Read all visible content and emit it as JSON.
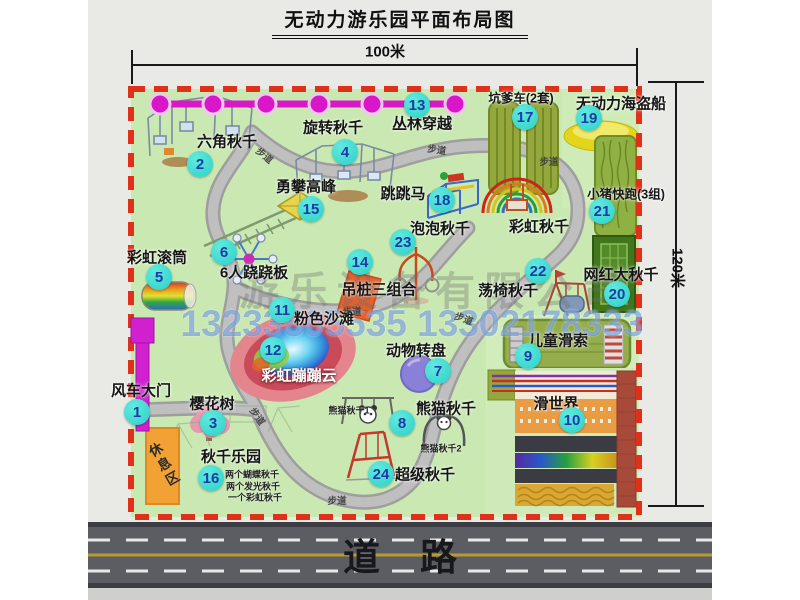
{
  "title": "无动力游乐园平面布局图",
  "dimensions": {
    "width_label": "100米",
    "height_label": "120米"
  },
  "road_label": "道路",
  "rest_area_label": "休息区",
  "watermark": {
    "company": "游乐设备有限公司",
    "phones": "13233805535 13302178333"
  },
  "map": {
    "attractions": [
      {
        "num": "1",
        "name": "windmill-gate",
        "label": "风车大门",
        "bx": 137,
        "by": 412,
        "lx": 141,
        "ly": 390
      },
      {
        "num": "2",
        "name": "hexagon-swing",
        "label": "六角秋千",
        "bx": 200,
        "by": 164,
        "lx": 227,
        "ly": 141
      },
      {
        "num": "3",
        "name": "cherry-tree",
        "label": "樱花树",
        "bx": 213,
        "by": 423,
        "lx": 212,
        "ly": 403
      },
      {
        "num": "4",
        "name": "rotating-swing",
        "label": "旋转秋千",
        "bx": 345,
        "by": 152,
        "lx": 333,
        "ly": 127
      },
      {
        "num": "5",
        "name": "rainbow-roller",
        "label": "彩虹滚筒",
        "bx": 159,
        "by": 277,
        "lx": 157,
        "ly": 257
      },
      {
        "num": "6",
        "name": "six-seesaw",
        "label": "6人跷跷板",
        "bx": 224,
        "by": 252,
        "lx": 254,
        "ly": 272
      },
      {
        "num": "7",
        "name": "animal-turntable",
        "label": "动物转盘",
        "bx": 438,
        "by": 371,
        "lx": 416,
        "ly": 350
      },
      {
        "num": "8",
        "name": "panda-swing",
        "label": "熊猫秋千",
        "bx": 402,
        "by": 423,
        "lx": 446,
        "ly": 408,
        "subs": [
          {
            "text": "熊猫秋千1",
            "x": 349,
            "y": 410
          },
          {
            "text": "熊猫秋千2",
            "x": 441,
            "y": 448
          }
        ]
      },
      {
        "num": "9",
        "name": "kids-zipline",
        "label": "儿童滑索",
        "bx": 528,
        "by": 356,
        "lx": 558,
        "ly": 340
      },
      {
        "num": "10",
        "name": "slide-world",
        "label": "滑世界",
        "bx": 572,
        "by": 420,
        "lx": 556,
        "ly": 403
      },
      {
        "num": "11",
        "name": "pink-beach",
        "label": "粉色沙滩",
        "bx": 282,
        "by": 310,
        "lx": 324,
        "ly": 318
      },
      {
        "num": "12",
        "name": "rainbow-cloud",
        "label": "彩虹蹦蹦云",
        "bx": 273,
        "by": 350,
        "lx": 299,
        "ly": 375,
        "light": true
      },
      {
        "num": "13",
        "name": "jungle-crossing",
        "label": "丛林穿越",
        "bx": 417,
        "by": 105,
        "lx": 422,
        "ly": 123
      },
      {
        "num": "14",
        "name": "hanging-piles",
        "label": "吊桩三组合",
        "bx": 360,
        "by": 262,
        "lx": 379,
        "ly": 289
      },
      {
        "num": "15",
        "name": "peak-climbing",
        "label": "勇攀高峰",
        "bx": 311,
        "by": 209,
        "lx": 306,
        "ly": 186
      },
      {
        "num": "16",
        "name": "swing-park",
        "label": "秋千乐园",
        "bx": 211,
        "by": 478,
        "lx": 231,
        "ly": 456,
        "subs": [
          {
            "text": "两个蝴蝶秋千",
            "x": 252,
            "y": 474
          },
          {
            "text": "两个发光秋千",
            "x": 253,
            "y": 486
          },
          {
            "text": "一个彩虹秋千",
            "x": 255,
            "y": 497
          }
        ]
      },
      {
        "num": "17",
        "name": "pit-cars",
        "label": "坑爹车(2套)",
        "bx": 525,
        "by": 117,
        "lx": 521,
        "ly": 97,
        "small": true
      },
      {
        "num": "18",
        "name": "jumping-horse",
        "label": "跳跳马",
        "bx": 442,
        "by": 200,
        "lx": 403,
        "ly": 193
      },
      {
        "num": "19",
        "name": "pirate-ship",
        "label": "无动力海盗船",
        "bx": 589,
        "by": 118,
        "lx": 621,
        "ly": 103
      },
      {
        "num": "20",
        "name": "big-swing",
        "label": "网红大秋千",
        "bx": 617,
        "by": 294,
        "lx": 621,
        "ly": 274
      },
      {
        "num": "21",
        "name": "pig-run",
        "label": "小猪快跑(3组)",
        "bx": 602,
        "by": 211,
        "lx": 626,
        "ly": 193,
        "small": true
      },
      {
        "num": "22",
        "name": "swing-chair",
        "label": "荡椅秋千",
        "bx": 538,
        "by": 271,
        "lx": 508,
        "ly": 290
      },
      {
        "num": "23",
        "name": "bubble-swing",
        "label": "泡泡秋千",
        "bx": 403,
        "by": 242,
        "lx": 440,
        "ly": 228
      },
      {
        "num": "24",
        "name": "super-swing",
        "label": "超级秋千",
        "bx": 381,
        "by": 474,
        "lx": 425,
        "ly": 474
      },
      {
        "num": "",
        "name": "rainbow-swing",
        "label": "彩虹秋千",
        "lx": 539,
        "ly": 226
      }
    ],
    "path_labels": [
      {
        "text": "步道",
        "x": 265,
        "y": 155,
        "r": 40
      },
      {
        "text": "步道",
        "x": 437,
        "y": 149,
        "r": 8
      },
      {
        "text": "步道",
        "x": 549,
        "y": 161,
        "r": 0
      },
      {
        "text": "步道",
        "x": 352,
        "y": 311,
        "r": 0
      },
      {
        "text": "步道",
        "x": 464,
        "y": 318,
        "r": 20
      },
      {
        "text": "步道",
        "x": 258,
        "y": 416,
        "r": 55
      },
      {
        "text": "步道",
        "x": 337,
        "y": 500,
        "r": 0
      }
    ]
  }
}
